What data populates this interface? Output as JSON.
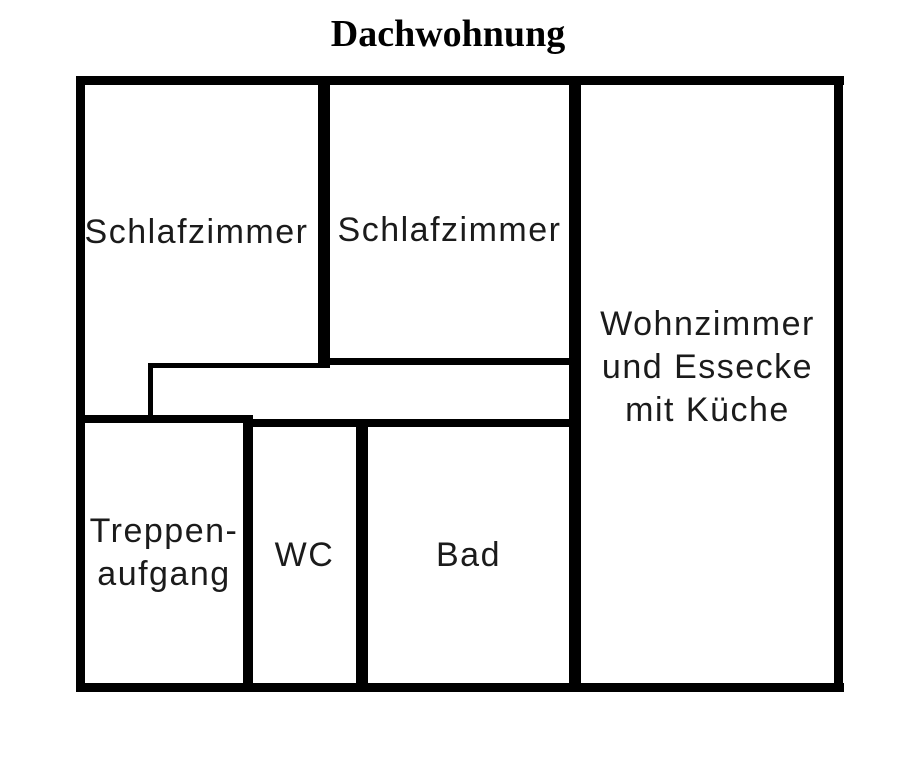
{
  "title": "Dachwohnung",
  "rooms": [
    {
      "id": "schlafzimmer-1",
      "lines": [
        "Schlafzimmer"
      ]
    },
    {
      "id": "schlafzimmer-2",
      "lines": [
        "Schlafzimmer"
      ]
    },
    {
      "id": "wohnzimmer-essecke-kueche",
      "lines": [
        "Wohnzimmer",
        "und Essecke",
        "mit Küche"
      ]
    },
    {
      "id": "treppenaufgang",
      "lines": [
        "Treppen-",
        "aufgang"
      ]
    },
    {
      "id": "wc",
      "lines": [
        "WC"
      ]
    },
    {
      "id": "bad",
      "lines": [
        "Bad"
      ]
    }
  ],
  "colors": {
    "wall": "#000000",
    "text": "#1b1b1b",
    "background": "#ffffff"
  }
}
